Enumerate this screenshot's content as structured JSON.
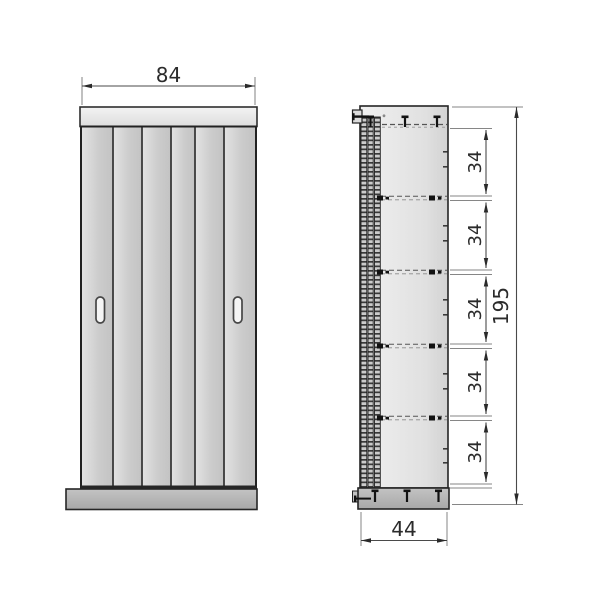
{
  "front_view": {
    "width_label": "84"
  },
  "side_view": {
    "depth_label": "44",
    "height_label": "195",
    "shelf_spacings": [
      "34",
      "34",
      "34",
      "34",
      "34"
    ]
  },
  "style": {
    "background": "#ffffff",
    "outline_color": "#2a2a2a",
    "panel_fill_light": "#ededed",
    "panel_fill_mid": "#d2d2d2",
    "panel_fill_dark": "#b2b2b2",
    "dimension_line_color": "#5a5a5a",
    "text_color": "#2b2b2b"
  }
}
